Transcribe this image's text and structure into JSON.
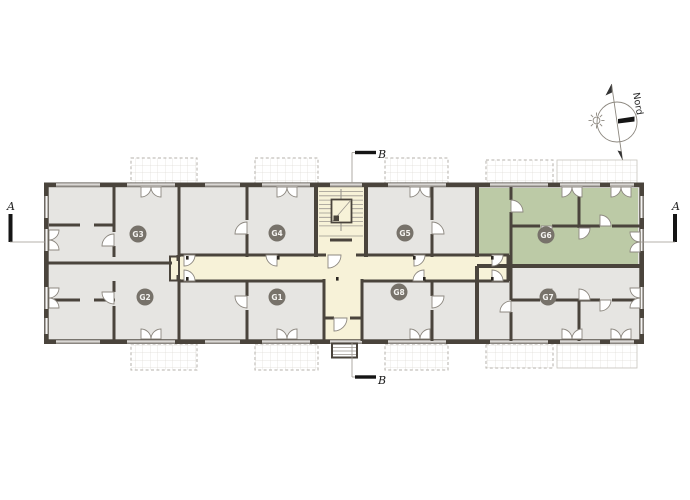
{
  "plan": {
    "units": [
      {
        "id": "G3",
        "x": 138,
        "y": 234,
        "highlighted": false
      },
      {
        "id": "G4",
        "x": 277,
        "y": 233,
        "highlighted": false
      },
      {
        "id": "G5",
        "x": 405,
        "y": 233,
        "highlighted": false
      },
      {
        "id": "G6",
        "x": 546,
        "y": 235,
        "highlighted": true
      },
      {
        "id": "G2",
        "x": 145,
        "y": 297,
        "highlighted": false
      },
      {
        "id": "G1",
        "x": 277,
        "y": 297,
        "highlighted": false
      },
      {
        "id": "G8",
        "x": 399,
        "y": 292,
        "highlighted": false
      },
      {
        "id": "G7",
        "x": 548,
        "y": 297,
        "highlighted": false
      }
    ],
    "section_markers": {
      "a_left": "A",
      "a_right": "A",
      "b_top": "B",
      "b_bottom": "B"
    },
    "compass_label": "Nord",
    "colors": {
      "wall": "#4a443c",
      "room": "#e6e5e2",
      "circulation": "#f7f2d8",
      "highlight": "#bccaa6",
      "badge": "#77726a",
      "badge_text": "#f4f3f0",
      "door": "#8d8880",
      "thin": "#9b968f"
    }
  }
}
